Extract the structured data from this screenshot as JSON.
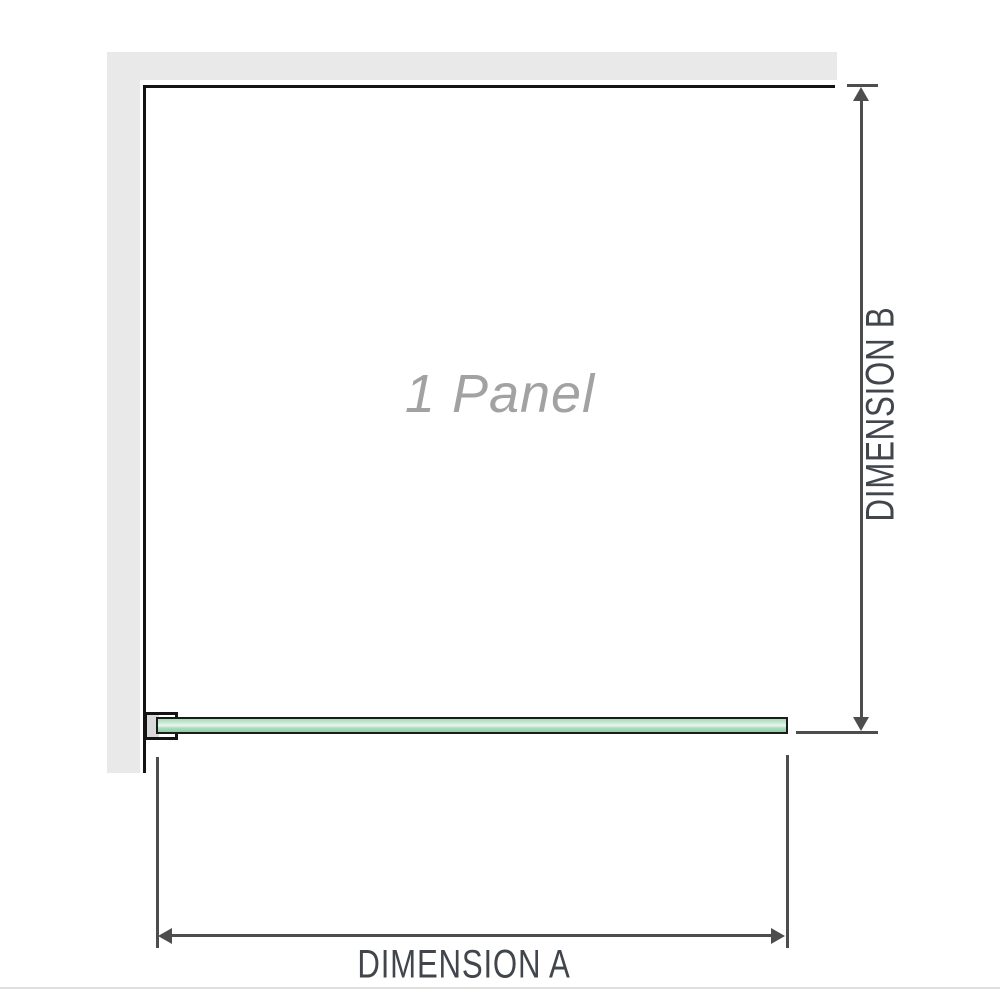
{
  "diagram": {
    "title": "Single glass panel dimension diagram",
    "panel_label": "1 Panel",
    "dimension_a_label": "DIMENSION A",
    "dimension_b_label": "DIMENSION B"
  },
  "colors": {
    "wall": "#e9e9e9",
    "outline": "#141414",
    "dimension": "#4d4d4d",
    "dimension_text": "#41454c",
    "panel_text": "#a2a2a2",
    "glass_border": "#1b1b1b",
    "glass_top": "#a9dabb",
    "glass_mid": "#e9f6ee",
    "glass_bottom": "#8fcda6",
    "bracket_pad": "#d9d9d9",
    "divider": "#dfdfdf"
  }
}
